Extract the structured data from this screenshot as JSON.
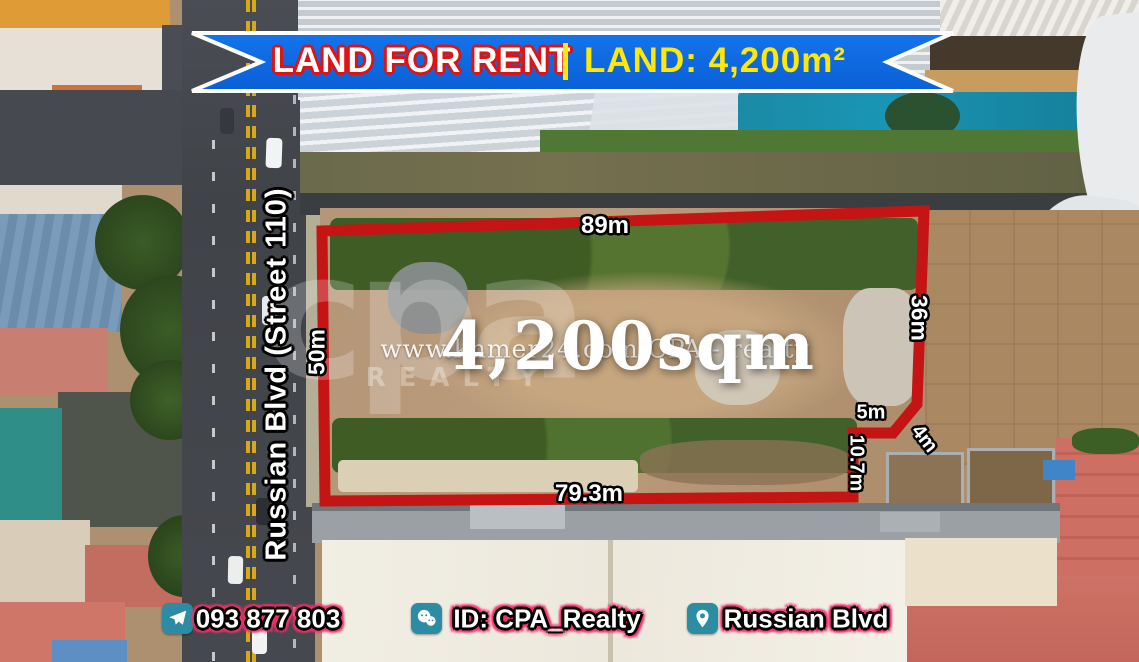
{
  "banner": {
    "title": "LAND FOR RENT",
    "divider": "|",
    "subtitle": "LAND: 4,200m²",
    "bg_color": "#0a6ce6",
    "title_color": "#ffffff",
    "title_outline_color": "#e01212",
    "subtitle_color": "#ffe70a"
  },
  "street": {
    "label": "Russian Blvd (Street 110)"
  },
  "plot": {
    "area_label": "4,200sqm",
    "outline_color": "#c41414",
    "dimensions": {
      "top": "89m",
      "left": "50m",
      "right": "36m",
      "step": "5m",
      "chamfer": "4m",
      "notch": "10.7m",
      "bottom": "79.3m"
    }
  },
  "watermark": {
    "url_text": "www.khmer24.com CPA - realty",
    "logo_text": "cpa",
    "logo_subtext": "REALTY"
  },
  "contact_bar": {
    "phone": "093 877 803",
    "wechat_id": "ID: CPA_Realty",
    "location": "Russian Blvd",
    "icon_bg_color": "#2b8ca4",
    "text_outline_color": "#f2316d"
  }
}
